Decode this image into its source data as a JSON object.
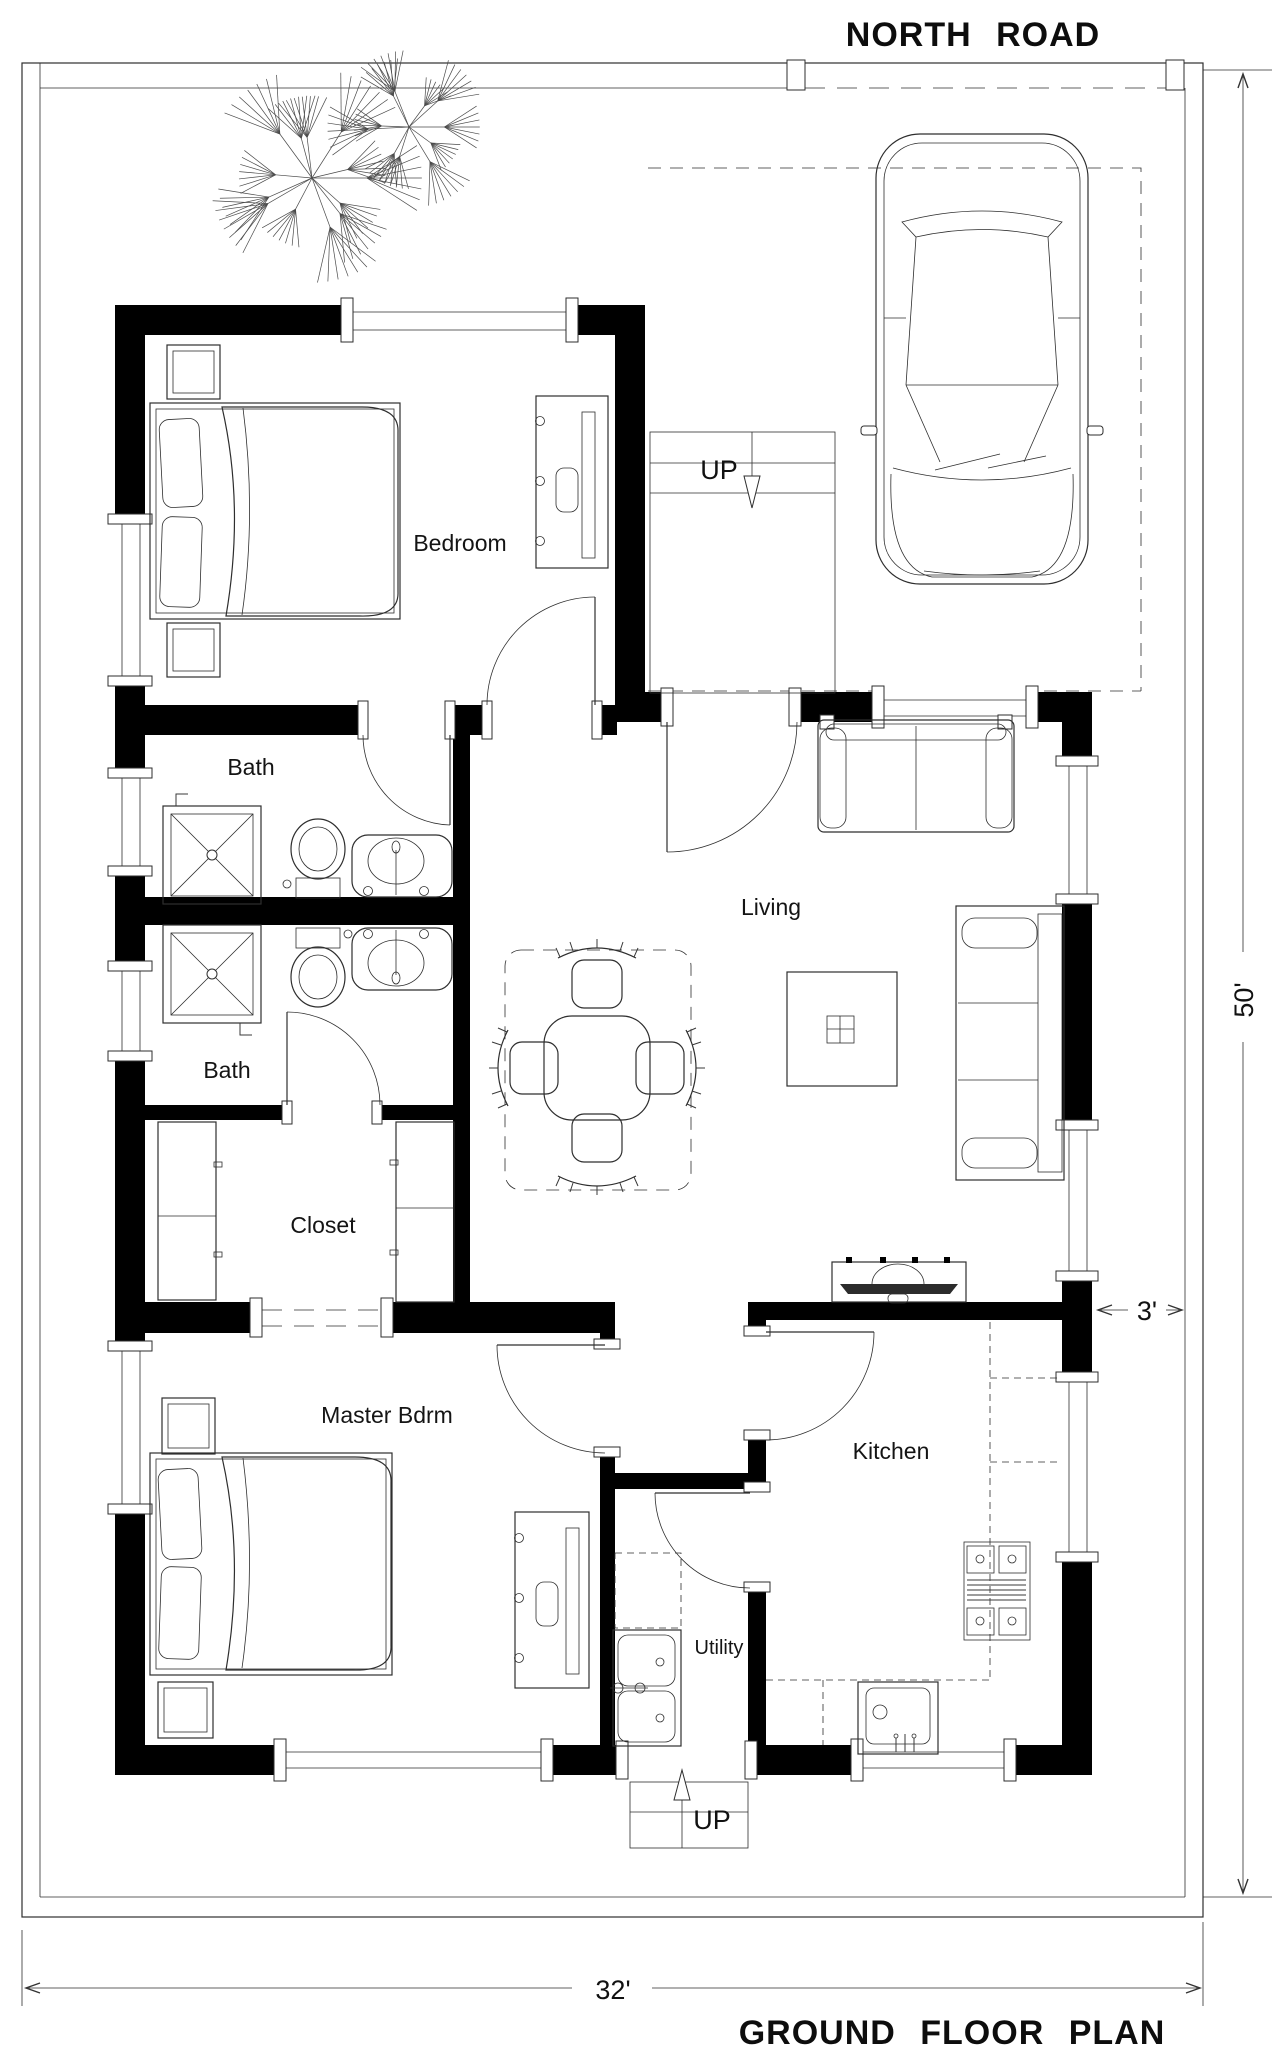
{
  "titles": {
    "road": "NORTH ROAD",
    "plan": "GROUND FLOOR PLAN"
  },
  "rooms": {
    "bedroom": "Bedroom",
    "bath_upper": "Bath",
    "bath_lower": "Bath",
    "closet": "Closet",
    "master": "Master Bdrm",
    "living": "Living",
    "kitchen": "Kitchen",
    "utility": "Utility"
  },
  "stairs": {
    "upper": "UP",
    "lower": "UP"
  },
  "dimensions": {
    "depth": "50'",
    "width": "32'",
    "setback": "3'"
  },
  "colors": {
    "wall": "#000000",
    "ink": "#2e2e2e",
    "label": "#141414"
  }
}
